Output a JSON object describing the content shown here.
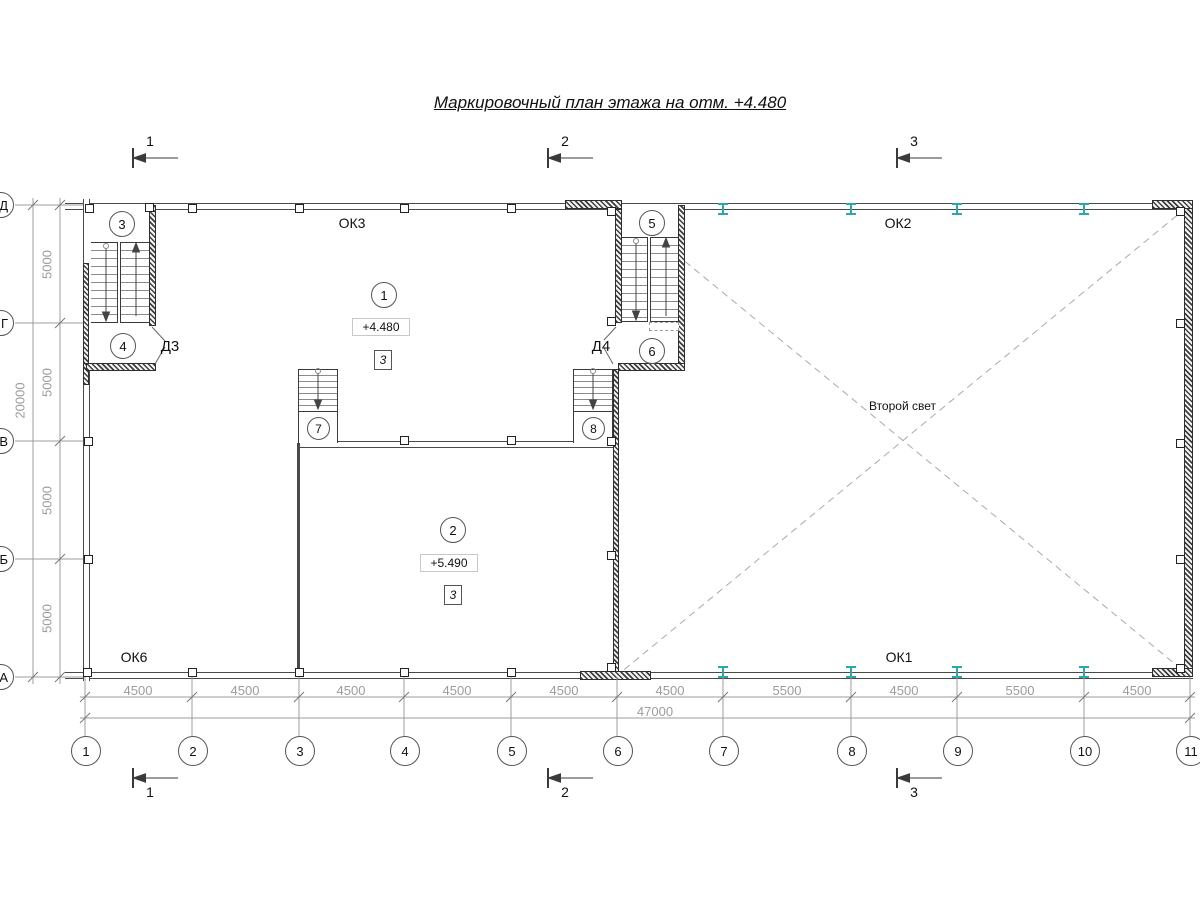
{
  "title": "Маркировочный план этажа на отм. +4.480",
  "section_marks": {
    "s1": "1",
    "s2": "2",
    "s3": "3"
  },
  "grid": {
    "cols": [
      "1",
      "2",
      "3",
      "4",
      "5",
      "6",
      "7",
      "8",
      "9",
      "10",
      "11"
    ],
    "rows": [
      "Д",
      "Г",
      "В",
      "Б",
      "А"
    ]
  },
  "dims": {
    "bottom": [
      "4500",
      "4500",
      "4500",
      "4500",
      "4500",
      "4500",
      "5500",
      "4500",
      "5500",
      "4500"
    ],
    "bottom_total": "47000",
    "left": [
      "5000",
      "5000",
      "5000",
      "5000"
    ],
    "left_total": "20000"
  },
  "windows": {
    "ok3": "ОК3",
    "ok2": "ОК2",
    "ok6": "ОК6",
    "ok1": "ОК1"
  },
  "doors": {
    "d3": "Д3",
    "d4": "Д4"
  },
  "zones": {
    "z1": "1",
    "z2": "2",
    "z3": "3",
    "z4": "4",
    "z5": "5",
    "z6": "6",
    "z7": "7",
    "z8": "8"
  },
  "rooms": {
    "room1_elev": "+4.480",
    "room2_elev": "+5.490",
    "type_mark": "3"
  },
  "notes": {
    "second_light": "Второй свет"
  },
  "colors": {
    "beam": "#2aa9ad"
  }
}
